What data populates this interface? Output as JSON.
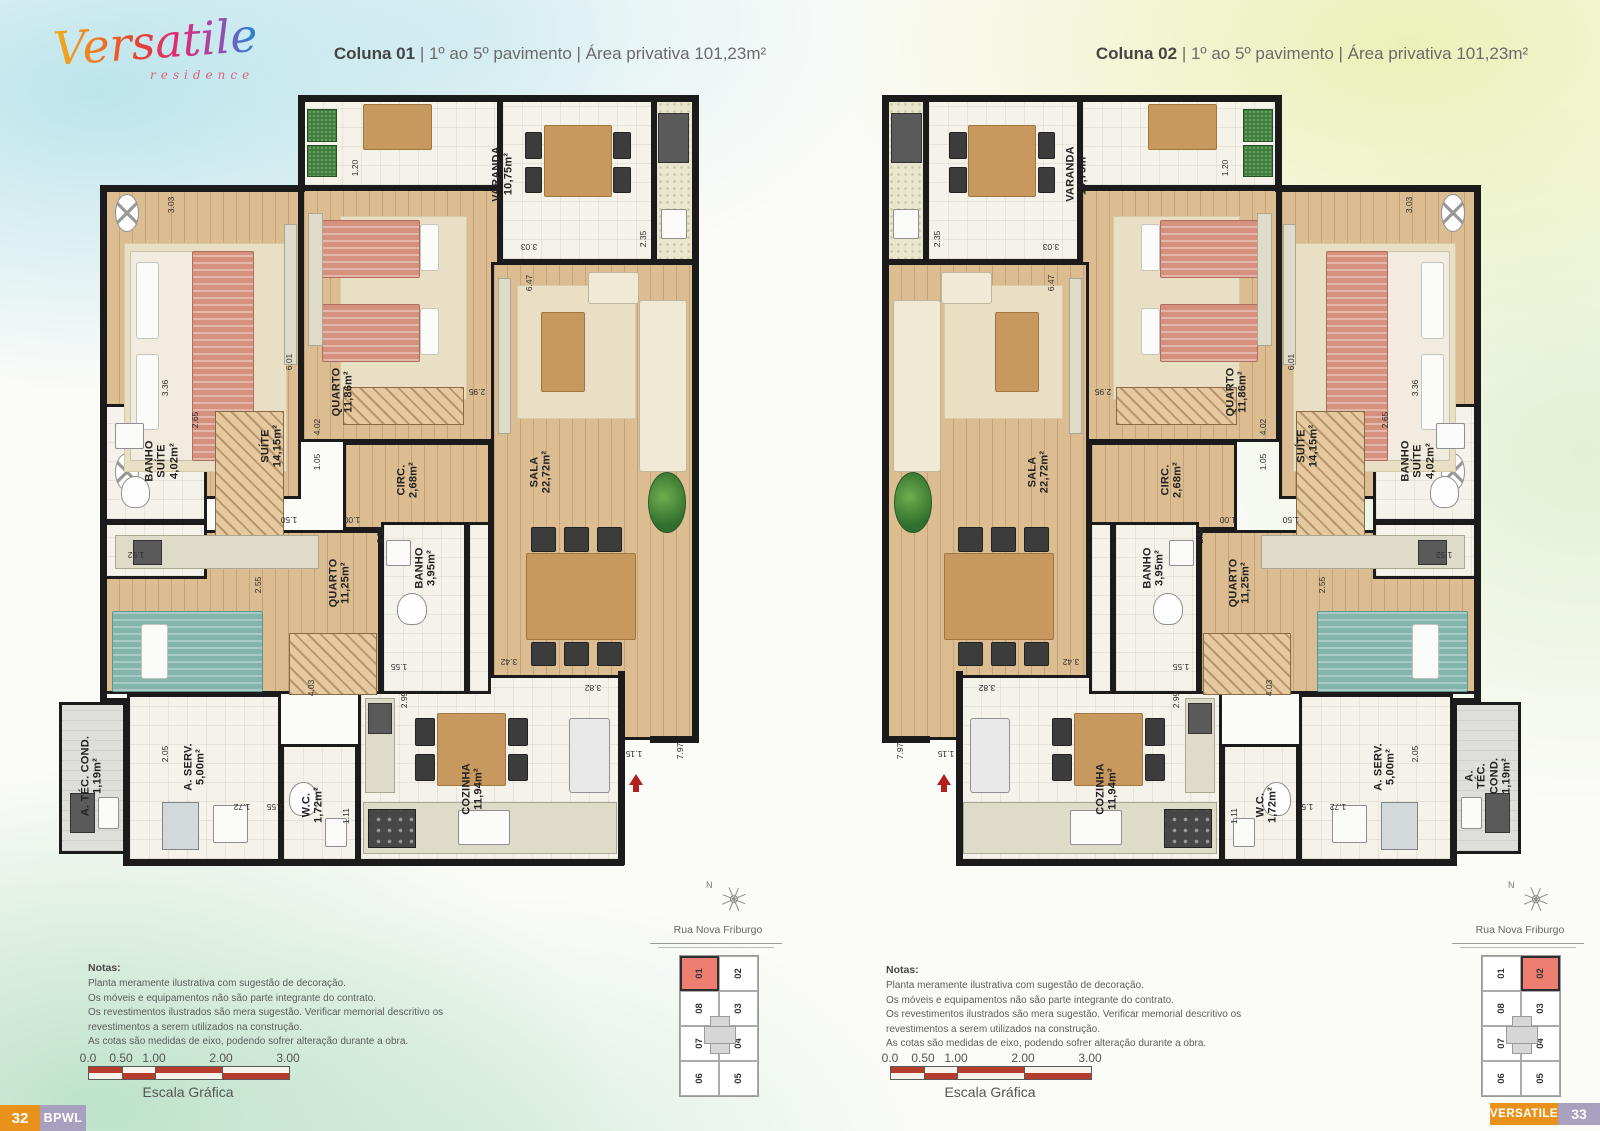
{
  "logo": {
    "brand": "Versatile",
    "subtitle": "residence"
  },
  "units": [
    {
      "column": "Coluna 01",
      "rest": "| 1º ao 5º pavimento | Área privativa 101,23m²",
      "key_highlight": "01"
    },
    {
      "column": "Coluna 02",
      "rest": "| 1º ao 5º pavimento | Área privativa 101,23m²",
      "key_highlight": "02"
    }
  ],
  "plan": {
    "rooms": [
      {
        "id": "varanda-strip",
        "rect": [
          0.335,
          0,
          0.335,
          0.118
        ],
        "floor": "tile"
      },
      {
        "id": "varanda",
        "name": "VARANDA",
        "area": "10,75m²",
        "rect": [
          0.67,
          0,
          0.26,
          0.215
        ],
        "floor": "tile",
        "lp": [
          0.675,
          0.1
        ]
      },
      {
        "id": "churrasqueira",
        "rect": [
          0.93,
          0,
          0.07,
          0.215
        ],
        "floor": "svc"
      },
      {
        "id": "suite",
        "name": "SUÍTE",
        "area": "14,15m²",
        "rect": [
          0,
          0.118,
          0.335,
          0.407
        ],
        "floor": "wood",
        "lp": [
          0.285,
          0.455
        ]
      },
      {
        "id": "quarto1",
        "name": "QUARTO",
        "area": "11,86m²",
        "rect": [
          0.335,
          0.118,
          0.335,
          0.332
        ],
        "floor": "wood",
        "lp": [
          0.405,
          0.385
        ]
      },
      {
        "id": "sala",
        "name": "SALA",
        "area": "22,72m²",
        "rect": [
          0.655,
          0.215,
          0.345,
          0.625
        ],
        "floor": "wood",
        "lp": [
          0.74,
          0.49
        ]
      },
      {
        "id": "circ",
        "name": "CIRC.",
        "area": "2,68m²",
        "rect": [
          0.405,
          0.45,
          0.25,
          0.115
        ],
        "floor": "wood",
        "lp": [
          0.515,
          0.5
        ]
      },
      {
        "id": "cozinha",
        "name": "COZINHA",
        "area": "11,94m²",
        "rect": [
          0.43,
          0.755,
          0.445,
          0.245
        ],
        "floor": "tile",
        "lp": [
          0.625,
          0.905
        ]
      },
      {
        "id": "cabinet-shaft",
        "rect": [
          0.615,
          0.555,
          0.04,
          0.225
        ],
        "floor": "tile"
      },
      {
        "id": "banho",
        "name": "BANHO",
        "area": "3,95m²",
        "rect": [
          0.47,
          0.555,
          0.145,
          0.225
        ],
        "floor": "tile",
        "lp": [
          0.545,
          0.615
        ]
      },
      {
        "id": "quarto2",
        "name": "QUARTO",
        "area": "11,25m²",
        "rect": [
          0,
          0.565,
          0.47,
          0.215
        ],
        "floor": "wood",
        "lp": [
          0.4,
          0.635
        ]
      },
      {
        "id": "banho-suite",
        "name": "BANHO\nSUÍTE",
        "area": "4,02m²",
        "rect": [
          0,
          0.4,
          0.175,
          0.155
        ],
        "floor": "tile",
        "lp": [
          0.1,
          0.475
        ]
      },
      {
        "id": "hall-suite",
        "rect": [
          0,
          0.555,
          0.175,
          0.075
        ],
        "floor": "tile"
      },
      {
        "id": "a-serv",
        "name": "A. SERV.",
        "area": "5,00m²",
        "rect": [
          0.04,
          0.78,
          0.26,
          0.22
        ],
        "floor": "tile",
        "lp": [
          0.155,
          0.875
        ]
      },
      {
        "id": "wc",
        "name": "W.C.",
        "area": "1,72m²",
        "rect": [
          0.3,
          0.845,
          0.13,
          0.155
        ],
        "floor": "tile",
        "lp": [
          0.355,
          0.925
        ]
      },
      {
        "id": "a-tec-cond",
        "name": "A. TÉC. COND.",
        "area": "1,19m²",
        "rect": [
          -0.075,
          0.79,
          0.115,
          0.2
        ],
        "floor": "svc2",
        "lp": [
          -0.018,
          0.888
        ]
      }
    ],
    "walls": [
      [
        0.335,
        0,
        1,
        0
      ],
      [
        0.335,
        0,
        0.335,
        0.118
      ],
      [
        0,
        0.118,
        0.335,
        0.118
      ],
      [
        0,
        0.118,
        0,
        0.79
      ],
      [
        0,
        0.79,
        0.04,
        0.79
      ],
      [
        0.04,
        0.79,
        0.04,
        1
      ],
      [
        0.04,
        1,
        0.875,
        1
      ],
      [
        0.875,
        0.755,
        0.875,
        1
      ],
      [
        1,
        0,
        1,
        0.84
      ],
      [
        0.93,
        0.84,
        1,
        0.84
      ]
    ],
    "dims": [
      [
        "3.03",
        0.115,
        0.14,
        -90
      ],
      [
        "3.36",
        0.105,
        0.38,
        -90
      ],
      [
        "6.01",
        0.315,
        0.345,
        -90
      ],
      [
        "2.65",
        0.155,
        0.422,
        -90
      ],
      [
        "1.52",
        0.055,
        0.598,
        180
      ],
      [
        "1.20",
        0.425,
        0.092,
        -90
      ],
      [
        "4.02",
        0.362,
        0.43,
        -90
      ],
      [
        "1.05",
        0.362,
        0.477,
        -90
      ],
      [
        "1.50",
        0.315,
        0.553,
        180
      ],
      [
        "1.00",
        0.42,
        0.553,
        180
      ],
      [
        "2.55",
        0.468,
        0.572,
        -90
      ],
      [
        "2.95",
        0.632,
        0.385,
        180
      ],
      [
        "3.03",
        0.72,
        0.195,
        180
      ],
      [
        "2.35",
        0.912,
        0.185,
        -90
      ],
      [
        "6.47",
        0.72,
        0.242,
        -90
      ],
      [
        "2.55",
        0.262,
        0.638,
        -90
      ],
      [
        "4.03",
        0.352,
        0.772,
        -90
      ],
      [
        "1.55",
        0.5,
        0.745,
        180
      ],
      [
        "2.99",
        0.508,
        0.788,
        -90
      ],
      [
        "2.05",
        0.105,
        0.858,
        -90
      ],
      [
        "1.72",
        0.235,
        0.928,
        180
      ],
      [
        "1.55",
        0.29,
        0.928,
        180
      ],
      [
        "1.11",
        0.41,
        0.94,
        -90
      ],
      [
        "3.42",
        0.685,
        0.738,
        180
      ],
      [
        "3.82",
        0.828,
        0.772,
        180
      ],
      [
        "1.15",
        0.897,
        0.858,
        180
      ],
      [
        "7.97",
        0.975,
        0.855,
        -90
      ]
    ],
    "furniture": [
      [
        "fan",
        0.02,
        0.125,
        0.04,
        0.05
      ],
      [
        "fan",
        0.02,
        0.465,
        0.04,
        0.05
      ],
      [
        "rug",
        0.035,
        0.19,
        0.275,
        0.3
      ],
      [
        "shet",
        0.045,
        0.2,
        0.21,
        0.275
      ],
      [
        "bedp",
        0.15,
        0.2,
        0.105,
        0.275
      ],
      [
        "pil",
        0.055,
        0.215,
        0.04,
        0.1
      ],
      [
        "pil",
        0.055,
        0.335,
        0.04,
        0.1
      ],
      [
        "cnt",
        0.305,
        0.165,
        0.022,
        0.185
      ],
      [
        "ward",
        0.19,
        0.41,
        0.115,
        0.2
      ],
      [
        "snk",
        0.02,
        0.425,
        0.05,
        0.035
      ],
      [
        "toi",
        0.03,
        0.495,
        0.05,
        0.042
      ],
      [
        "rug",
        0.4,
        0.155,
        0.215,
        0.24
      ],
      [
        "bedp",
        0.37,
        0.16,
        0.165,
        0.075
      ],
      [
        "pil",
        0.535,
        0.165,
        0.033,
        0.062
      ],
      [
        "bedp",
        0.37,
        0.27,
        0.165,
        0.075
      ],
      [
        "pil",
        0.535,
        0.275,
        0.033,
        0.062
      ],
      [
        "ward",
        0.405,
        0.378,
        0.205,
        0.05
      ],
      [
        "cnt",
        0.347,
        0.15,
        0.024,
        0.175
      ],
      [
        "plnt2",
        0.345,
        0.015,
        0.05,
        0.042
      ],
      [
        "plnt2",
        0.345,
        0.062,
        0.05,
        0.042
      ],
      [
        "tbl",
        0.44,
        0.008,
        0.115,
        0.06
      ],
      [
        "tbl",
        0.745,
        0.035,
        0.115,
        0.095
      ],
      [
        "chr",
        0.712,
        0.045,
        0.03,
        0.035
      ],
      [
        "chr",
        0.712,
        0.09,
        0.03,
        0.035
      ],
      [
        "chr",
        0.862,
        0.045,
        0.03,
        0.035
      ],
      [
        "chr",
        0.862,
        0.09,
        0.03,
        0.035
      ],
      [
        "appl",
        0.938,
        0.02,
        0.052,
        0.065
      ],
      [
        "snk",
        0.942,
        0.145,
        0.045,
        0.04
      ],
      [
        "cnt",
        0.668,
        0.235,
        0.022,
        0.205
      ],
      [
        "rug",
        0.7,
        0.245,
        0.2,
        0.175
      ],
      [
        "tbl",
        0.74,
        0.28,
        0.075,
        0.105
      ],
      [
        "sofa",
        0.905,
        0.265,
        0.082,
        0.225
      ],
      [
        "sofa",
        0.82,
        0.228,
        0.085,
        0.042
      ],
      [
        "plant",
        0.92,
        0.49,
        0.065,
        0.08
      ],
      [
        "tbl",
        0.715,
        0.595,
        0.185,
        0.115
      ],
      [
        "chr",
        0.723,
        0.562,
        0.042,
        0.032
      ],
      [
        "chr",
        0.779,
        0.562,
        0.042,
        0.032
      ],
      [
        "chr",
        0.835,
        0.562,
        0.042,
        0.032
      ],
      [
        "chr",
        0.723,
        0.712,
        0.042,
        0.032
      ],
      [
        "chr",
        0.779,
        0.712,
        0.042,
        0.032
      ],
      [
        "chr",
        0.835,
        0.712,
        0.042,
        0.032
      ],
      [
        "snk",
        0.478,
        0.578,
        0.042,
        0.035
      ],
      [
        "toi",
        0.497,
        0.648,
        0.05,
        0.042
      ],
      [
        "cnt",
        0.02,
        0.572,
        0.345,
        0.045
      ],
      [
        "appl",
        0.05,
        0.578,
        0.05,
        0.033
      ],
      [
        "bedt",
        0.015,
        0.672,
        0.255,
        0.105
      ],
      [
        "pil",
        0.065,
        0.688,
        0.045,
        0.072
      ],
      [
        "ward",
        0.315,
        0.7,
        0.148,
        0.082
      ],
      [
        "wsh",
        0.1,
        0.922,
        0.062,
        0.062
      ],
      [
        "snk",
        0.185,
        0.925,
        0.06,
        0.05
      ],
      [
        "toi",
        0.315,
        0.895,
        0.048,
        0.045
      ],
      [
        "snk",
        0.375,
        0.942,
        0.038,
        0.038
      ],
      [
        "cnt",
        0.44,
        0.922,
        0.428,
        0.068
      ],
      [
        "stv",
        0.447,
        0.93,
        0.082,
        0.052
      ],
      [
        "snk",
        0.6,
        0.932,
        0.088,
        0.046
      ],
      [
        "frg",
        0.788,
        0.812,
        0.068,
        0.098
      ],
      [
        "cnt",
        0.443,
        0.785,
        0.05,
        0.125
      ],
      [
        "appl",
        0.448,
        0.792,
        0.04,
        0.04
      ],
      [
        "tbl",
        0.565,
        0.805,
        0.115,
        0.095
      ],
      [
        "chr",
        0.527,
        0.812,
        0.034,
        0.036
      ],
      [
        "chr",
        0.527,
        0.858,
        0.034,
        0.036
      ],
      [
        "chr",
        0.684,
        0.812,
        0.034,
        0.036
      ],
      [
        "chr",
        0.684,
        0.858,
        0.034,
        0.036
      ],
      [
        "appl",
        -0.055,
        0.91,
        0.042,
        0.052
      ],
      [
        "snk",
        -0.008,
        0.915,
        0.035,
        0.042
      ]
    ],
    "entry_arrow": [
      0.9,
      0.885
    ]
  },
  "keyplan": {
    "north": "N",
    "street": "Rua Nova Friburgo",
    "cols": [
      [
        "01",
        "08",
        "07",
        "06"
      ],
      [
        "02",
        "03",
        "04",
        "05"
      ]
    ]
  },
  "notes": {
    "title": "Notas:",
    "lines": [
      "Planta meramente ilustrativa com sugestão de decoração.",
      "Os móveis e equipamentos não são parte integrante do contrato.",
      "Os revestimentos ilustrados são mera sugestão. Verificar memorial descritivo os",
      "revestimentos a serem utilizados na construção.",
      "As cotas são medidas de eixo, podendo sofrer alteração durante a obra."
    ]
  },
  "scale": {
    "ticks": [
      "0.0",
      "0.50",
      "1.00",
      "2.00",
      "3.00"
    ],
    "label": "Escala Gráfica"
  },
  "footer": {
    "page_left": "32",
    "brand_left": "BPWL",
    "brand_right": "VERSATILE",
    "page_right": "33"
  },
  "colors": {
    "accent_orange": "#e8921c",
    "accent_lilac": "#a7a0bf",
    "highlight_red": "#ee7d72",
    "wall": "#1b1b1b",
    "scale_red": "#b63c2e",
    "wood": "#dcbd92"
  }
}
